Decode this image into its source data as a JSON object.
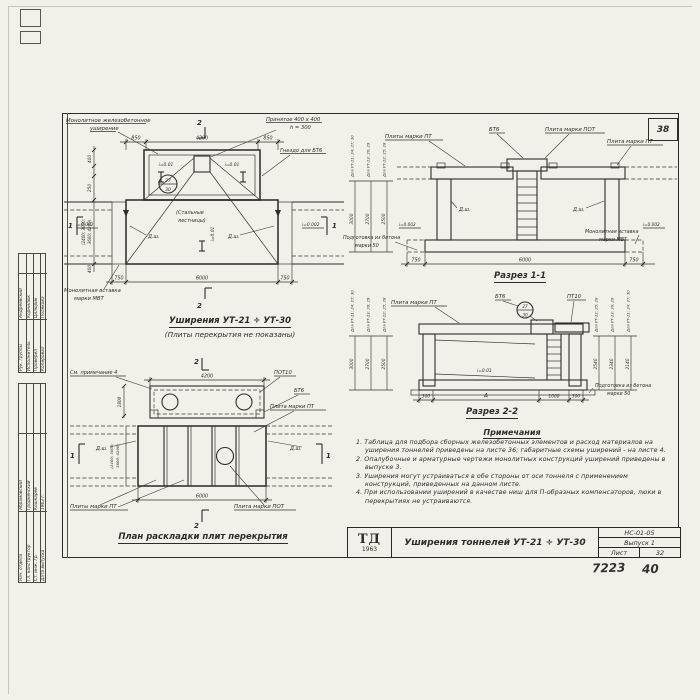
{
  "sheet": {
    "corner_no": "38"
  },
  "stamps": {
    "top_rows": [
      {
        "role": "Рук. группы",
        "name": "Андреевский"
      },
      {
        "role": "Исполнитель",
        "name": "Корнилюк"
      },
      {
        "role": "Проверил",
        "name": "Цилюрик"
      },
      {
        "role": "Копировал",
        "name": "Полякова"
      }
    ],
    "bottom_rows": [
      {
        "role": "Нач. отдела",
        "name": "Абрамовский"
      },
      {
        "role": "Гл. конструктор",
        "name": "Гродненский"
      },
      {
        "role": "Ст. инж. гр.",
        "name": "Кошкарёв"
      },
      {
        "role": "Дата выпуска",
        "name": "1963 г."
      }
    ]
  },
  "plan": {
    "cut2": "2",
    "cut1": "1",
    "lbl_widening1": "Монолитное железобетонное",
    "lbl_widening2": "уширение",
    "lbl_adopted1": "Принятое 400 х 400",
    "lbl_adopted2": "h = 300",
    "lbl_socket": "Гнездо для БТ6",
    "lbl_ladders1": "(Стальные",
    "lbl_ladders2": "лестницы)",
    "lbl_insert1": "Монолитная вставка",
    "lbl_insert2": "марки МВТ",
    "detail_top": "27",
    "detail_bot": "30",
    "slope1": "i=0.01",
    "slope2": "i=0.002",
    "joint": "Д.ш.",
    "dim_top": [
      "850",
      "4200",
      "850"
    ],
    "dim_bottom": [
      "750",
      "6000",
      "750"
    ],
    "dim_left": [
      "400",
      "250",
      "(2400; 3000;",
      "3600; 4200)",
      "400"
    ],
    "title": "Уширения УТ-21 ÷ УТ-30",
    "subtitle": "(Плиты перекрытия не показаны)"
  },
  "section1": {
    "cols": [
      {
        "label": "Для УТ-21; 24; 27; 30",
        "dim": "3000"
      },
      {
        "label": "Для УТ-23; 26; 29",
        "dim": "2700"
      },
      {
        "label": "Для УТ-22; 25; 28",
        "dim": "2500"
      }
    ],
    "lbl_pt_plural": "Плиты марки ПТ",
    "lbl_bt6": "БТ6",
    "lbl_pot": "Плита марки ПОТ",
    "lbl_pt": "Плита марки ПТ",
    "joint": "Д.ш.",
    "slope": "i=0.002",
    "lbl_base1": "Подготовка из бетона",
    "lbl_base2": "марки 50",
    "lbl_insert1": "Монолитная вставка",
    "lbl_insert2": "марки МВТ",
    "dim_bottom": [
      "750",
      "6000",
      "750"
    ],
    "title": "Разрез 1-1"
  },
  "section2": {
    "left_cols": [
      {
        "label": "Для УТ-21; 24; 27; 30",
        "dim": "3000"
      },
      {
        "label": "Для УТ-23; 26; 29",
        "dim": "2700"
      },
      {
        "label": "Для УТ-22; 25; 28",
        "dim": "2500"
      }
    ],
    "right_cols": [
      {
        "label": "Для УТ-22; 25; 28",
        "dim": "2540"
      },
      {
        "label": "Для УТ-23; 26; 29",
        "dim": "2340"
      },
      {
        "label": "Для УТ-21; 24; 27; 30",
        "dim": "2140"
      }
    ],
    "lbl_pt": "Плита марки ПТ",
    "lbl_bt6": "БТ6",
    "lbl_pt10": "ПТ10",
    "detail_top": "27",
    "detail_bot": "30",
    "slope": "i=0.01",
    "lbl_base1": "Подготовка из бетона",
    "lbl_base2": "марки 50",
    "dim_bottom": [
      "300",
      "А",
      "1000",
      "300"
    ],
    "title": "Разрез 2-2"
  },
  "layout": {
    "cut1": "1",
    "cut2": "2",
    "note_ref": "См. примечание 4",
    "lbl_pot10": "ПОТ10",
    "lbl_bt6": "БТ6",
    "lbl_pt": "Плита марки ПТ",
    "joint": "Д.ш.",
    "lbl_pt_plural": "Плиты марки ПТ",
    "lbl_pot": "Плита марки ПОТ",
    "dim_top": "4200",
    "dim_left": "1800",
    "dim_left_rot1": "(2400; 3000;",
    "dim_left_rot2": "3600; 4200)",
    "dim_bottom": "6000",
    "title": "План раскладки плит перекрытия"
  },
  "notes": {
    "header": "Примечания",
    "items": [
      "1. Таблица для подбора сборных железобетонных элементов и расход материалов на уширения тоннелей приведены на листе 36; габаритные схемы уширений - на листе 4.",
      "2. Опалубочные и арматурные чертежи монолитных конструкций уширений приведены в выпуске 3.",
      "3. Уширения могут устраиваться в обе стороны от оси тоннеля с применением конструкций, приведенных на данном листе.",
      "4. При использовании уширений в качестве ниш для П-образных компенсаторов, люки в перекрытиях не устраиваются."
    ]
  },
  "title_block": {
    "logo_top": "ТД",
    "logo_year": "1963",
    "title": "Уширения тоннелей УТ-21 ÷ УТ-30",
    "code": "НС-01-05",
    "issue": "Выпуск 1",
    "sheet_word": "Лист",
    "sheet_no": "32"
  },
  "annotations": {
    "hand1": "7223",
    "hand2": "40"
  }
}
